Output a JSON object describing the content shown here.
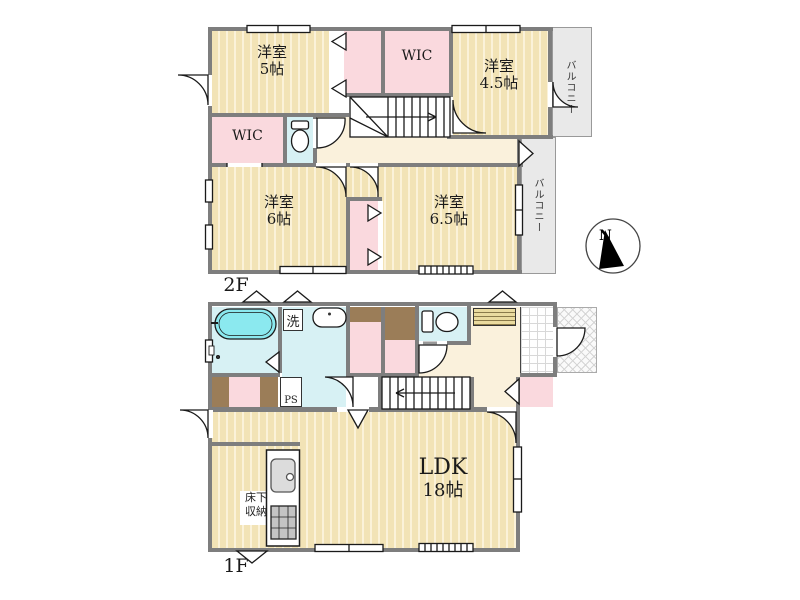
{
  "title": "間取り図",
  "colors": {
    "wall": "#7E7E7E",
    "floor_tan": "#F2E3B6",
    "closet_pink": "#FAD9DE",
    "wet_area_blue": "#D7F1F4",
    "hall_cream": "#FAF1DC",
    "bathtub_cyan": "#8BE9EF",
    "balcony_gray": "#E9E9E9",
    "oshiire_brown": "#9B7D58"
  },
  "floor2": {
    "label": "2F",
    "room5": {
      "name": "洋室",
      "size": "5帖"
    },
    "wic_top": {
      "name": "WIC"
    },
    "room45": {
      "name": "洋室",
      "size": "4.5帖"
    },
    "wic_left": {
      "name": "WIC"
    },
    "room6": {
      "name": "洋室",
      "size": "6帖"
    },
    "room65": {
      "name": "洋室",
      "size": "6.5帖"
    },
    "balcony_top": {
      "name": "バルコニー"
    },
    "balcony_right": {
      "name": "バルコニー"
    }
  },
  "floor1": {
    "label": "1F",
    "laundry": {
      "name": "洗"
    },
    "pipe_space": {
      "name": "PS"
    },
    "ldk": {
      "name": "LDK",
      "size": "18帖"
    },
    "underfloor_storage": {
      "line1": "床下",
      "line2": "収納"
    }
  },
  "compass": {
    "north": "N"
  }
}
